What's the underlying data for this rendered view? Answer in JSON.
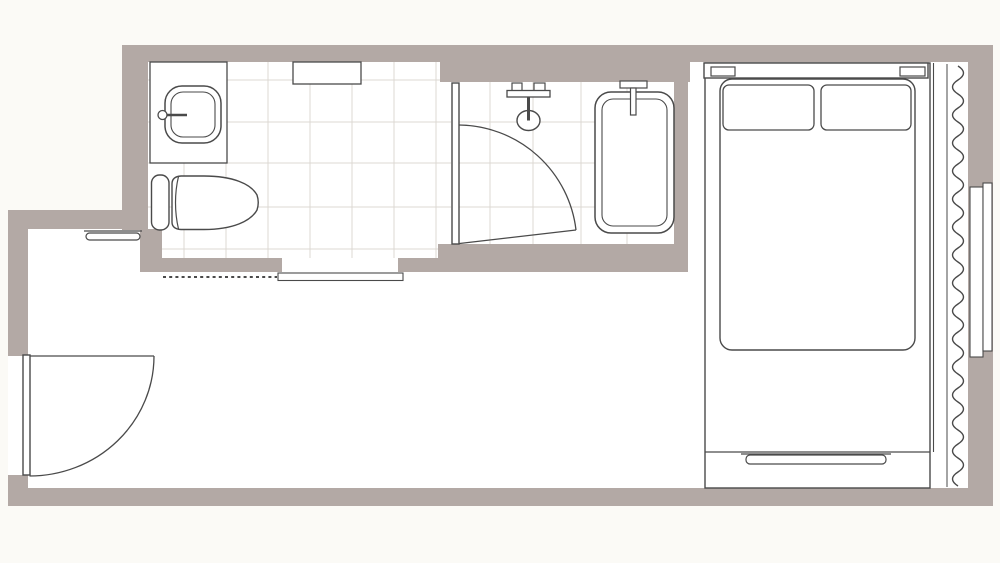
{
  "colors": {
    "page_background": "#fbfaf6",
    "floor": "#ffffff",
    "wall": "#b3a9a5",
    "outline": "#4a4a4a",
    "tile_line": "#dcd8d3"
  },
  "plan": {
    "kind": "hotel-room-floor-plan",
    "visible_text": [],
    "rooms": [
      "vanity-room",
      "bathroom",
      "bedroom-living-area"
    ],
    "fixtures": [
      "washbasin-counter",
      "washbasin",
      "faucet",
      "toilet",
      "vanity-shelf",
      "bathroom-door",
      "shower-mixer",
      "shower-head",
      "bathtub",
      "bath-filler",
      "threshold",
      "dashed-opening-line",
      "console-shelf",
      "entrance-door",
      "double-bed",
      "headboard",
      "pillows",
      "bed-runner",
      "curtain",
      "curtain-rail",
      "window-panes"
    ]
  }
}
